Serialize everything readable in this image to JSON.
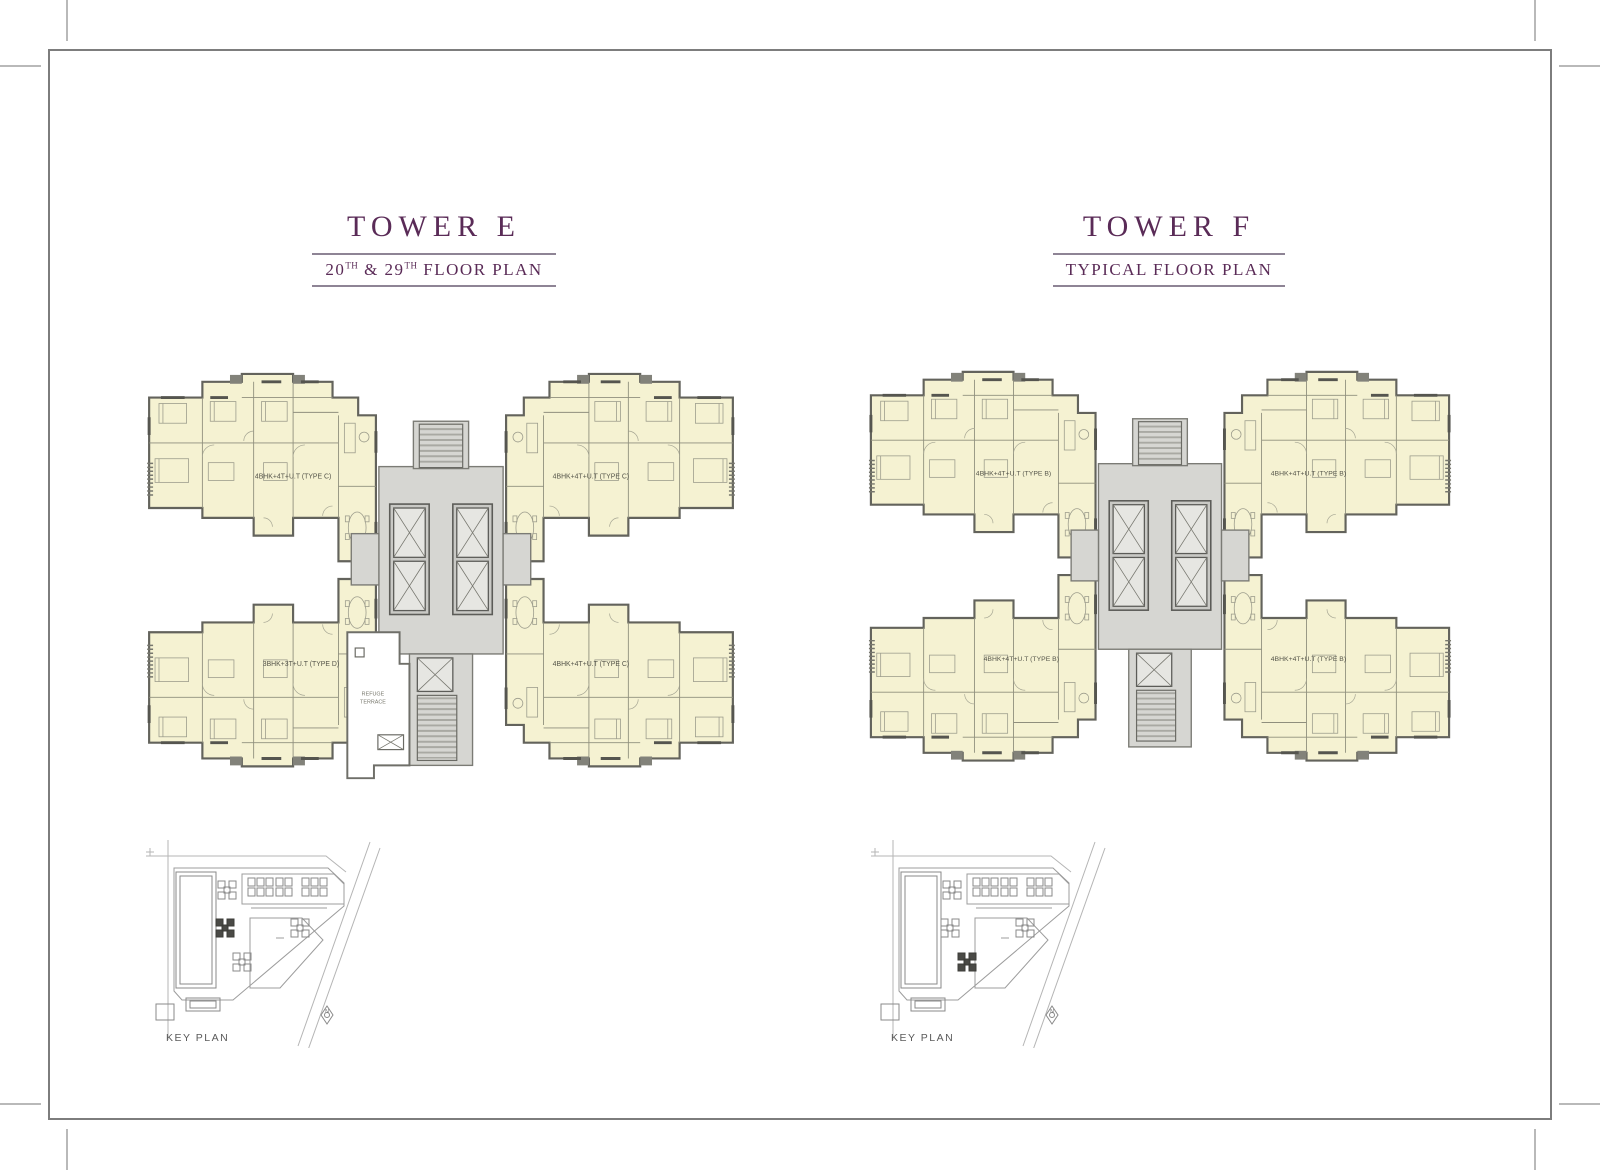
{
  "page": {
    "accent": "#5a2b57",
    "background": "#ffffff"
  },
  "towers": {
    "e": {
      "title": "TOWER E",
      "subtitle": {
        "p1": "20",
        "s1": "TH",
        "p2": " & 29",
        "s2": "TH",
        "p3": " FLOOR PLAN",
        "plain": "20TH & 29TH FLOOR PLAN"
      },
      "units": {
        "tl": "4BHK+4T+U.T (TYPE C)",
        "tr": "4BHK+4T+U.T (TYPE C)",
        "bl": "3BHK+3T+U.T (TYPE D)",
        "br": "4BHK+4T+U.T (TYPE C)"
      },
      "refuge": {
        "line1": "REFUGE",
        "line2": "TERRACE"
      },
      "key_plan": {
        "label": "KEY PLAN",
        "highlight": "mid",
        "north": "N"
      }
    },
    "f": {
      "title": "TOWER F",
      "subtitle": {
        "p1": "TYPICAL FLOOR PLAN",
        "s1": "",
        "p2": "",
        "s2": "",
        "p3": "",
        "plain": "TYPICAL FLOOR PLAN"
      },
      "units": {
        "tl": "4BHK+4T+U.T (TYPE B)",
        "tr": "4BHK+4T+U.T (TYPE B)",
        "bl": "4BHK+4T+U.T (TYPE B)",
        "br": "4BHK+4T+U.T (TYPE B)"
      },
      "key_plan": {
        "label": "KEY PLAN",
        "highlight": "low",
        "north": "N"
      }
    }
  }
}
